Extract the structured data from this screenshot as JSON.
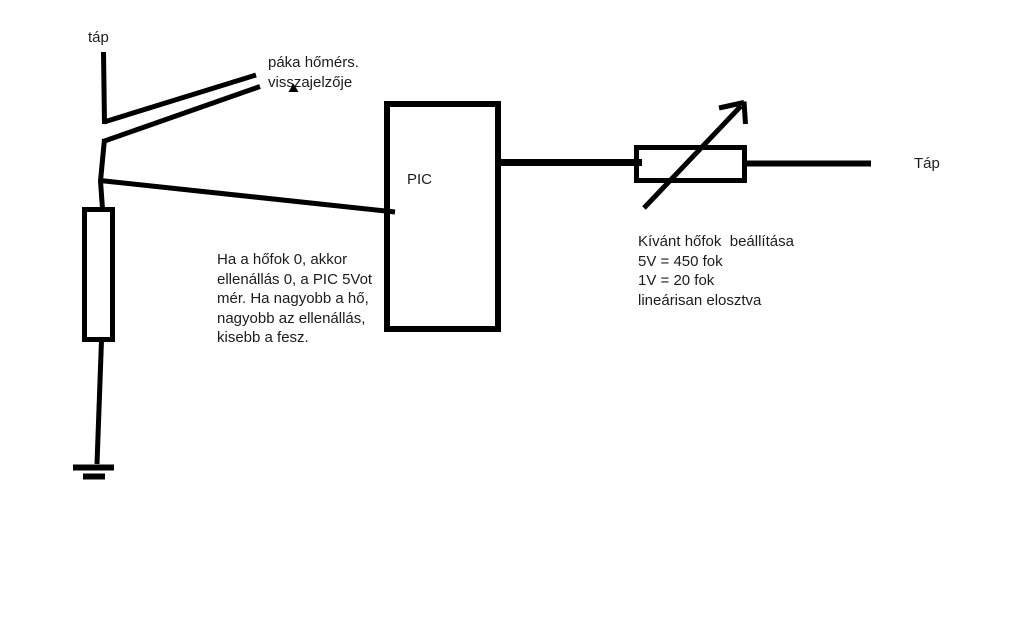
{
  "canvas": {
    "background_color": "#ffffff",
    "ink_color": "#000000",
    "text_color": "#1c1c1c"
  },
  "labels": {
    "tap_left": "táp",
    "tap_right": "Táp",
    "pic": "PIC",
    "sensor_line1": "páka hőmérs.",
    "sensor_line2": "visszajelzője"
  },
  "notes": {
    "left_note": [
      "Ha a hőfok 0, akkor",
      "ellenállás 0, a PIC 5Vot",
      "mér. Ha nagyobb a hő,",
      "nagyobb az ellenállás,",
      "kisebb a fesz."
    ],
    "right_note": [
      "Kívánt hőfok  beállítása",
      "5V = 450 fok",
      "1V = 20 fok",
      "lineárisan elosztva"
    ]
  }
}
